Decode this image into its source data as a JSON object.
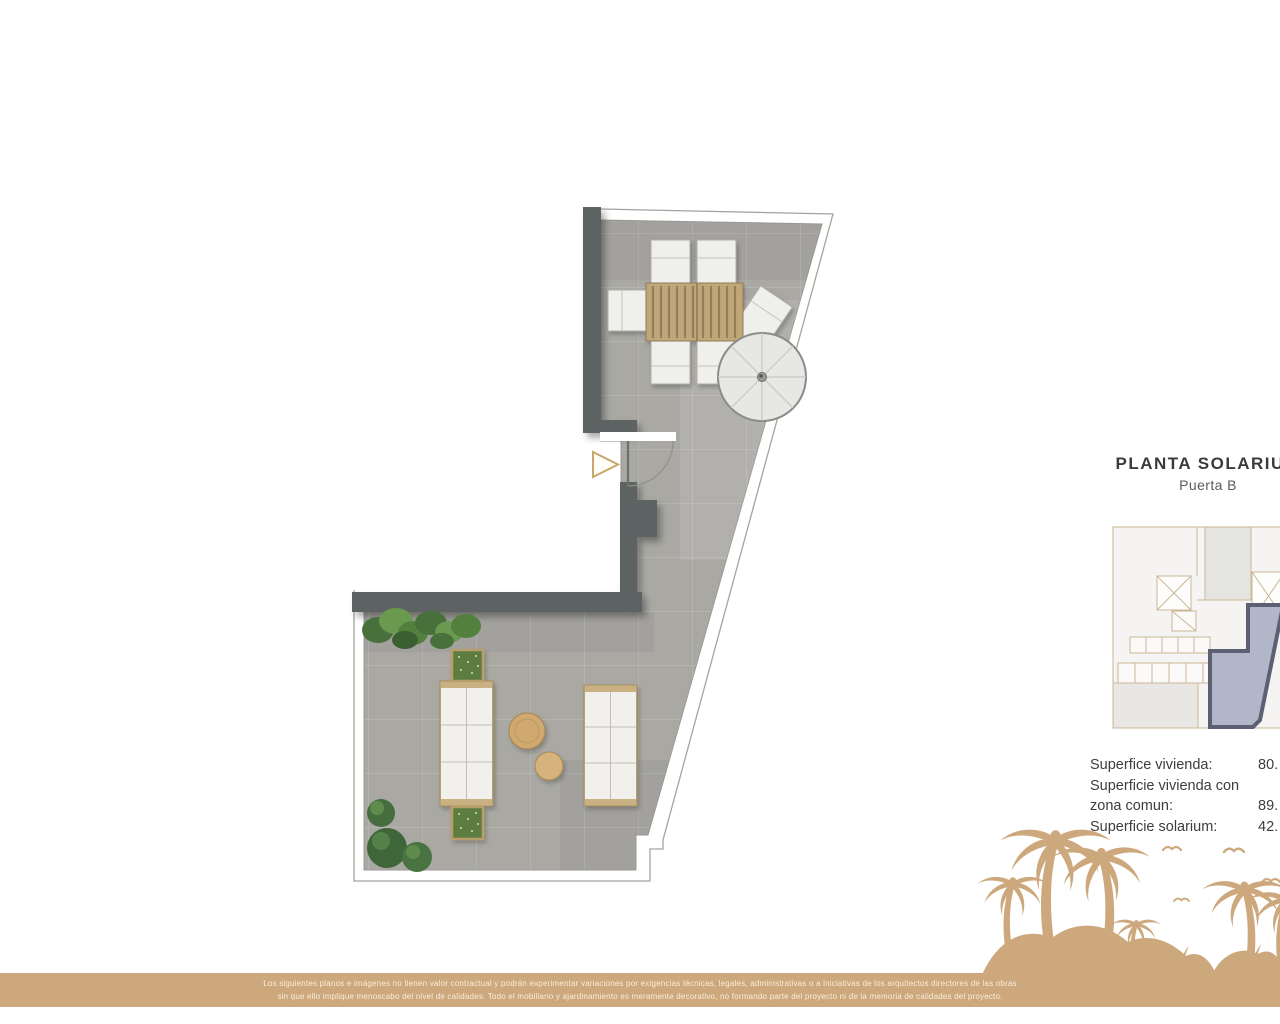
{
  "right_panel": {
    "title": "PLANTA SOLARIUM",
    "subtitle": "Puerta B",
    "areas": [
      {
        "label": "Superfice vivienda:",
        "value": "80."
      },
      {
        "label": "Superficie vivienda con",
        "value": ""
      },
      {
        "label": "zona comun:",
        "value": "89."
      },
      {
        "label": "Superficie solarium:",
        "value": "42."
      }
    ]
  },
  "plan": {
    "colors": {
      "floor": "#a9a8a3",
      "tile_line": "#bcbbb6",
      "wall": "#5d6462",
      "wood": "#c1a679",
      "white_furniture": "#efefec",
      "accent_gold": "#c9a769",
      "plant_green": "#53803d",
      "planter_green": "#5d7d3f",
      "boundary_line": "#a3a39e"
    }
  },
  "key_plan": {
    "colors": {
      "outline": "#cbb795",
      "body_fill": "#f5f4f2",
      "gray_fill": "#e4e4e1",
      "highlight_fill": "#b2b6c9",
      "highlight_border": "#5b6173"
    }
  },
  "art": {
    "color": "#cda87d"
  },
  "footer": {
    "band_color": "#cda87d",
    "line1": "Los siguientes planos e imágenes no tienen valor contractual y podrán experimentar variaciones por exigencias técnicas, legales, administrativas o a iniciativas de los arquitectos directores de las obras",
    "line2": "sin que ello implique menoscabo del nivel de calidades. Todo el mobiliario y ajardinamiento es meramente decorativo, no formando parte del proyecto ni de la memoria de calidades del proyecto."
  }
}
